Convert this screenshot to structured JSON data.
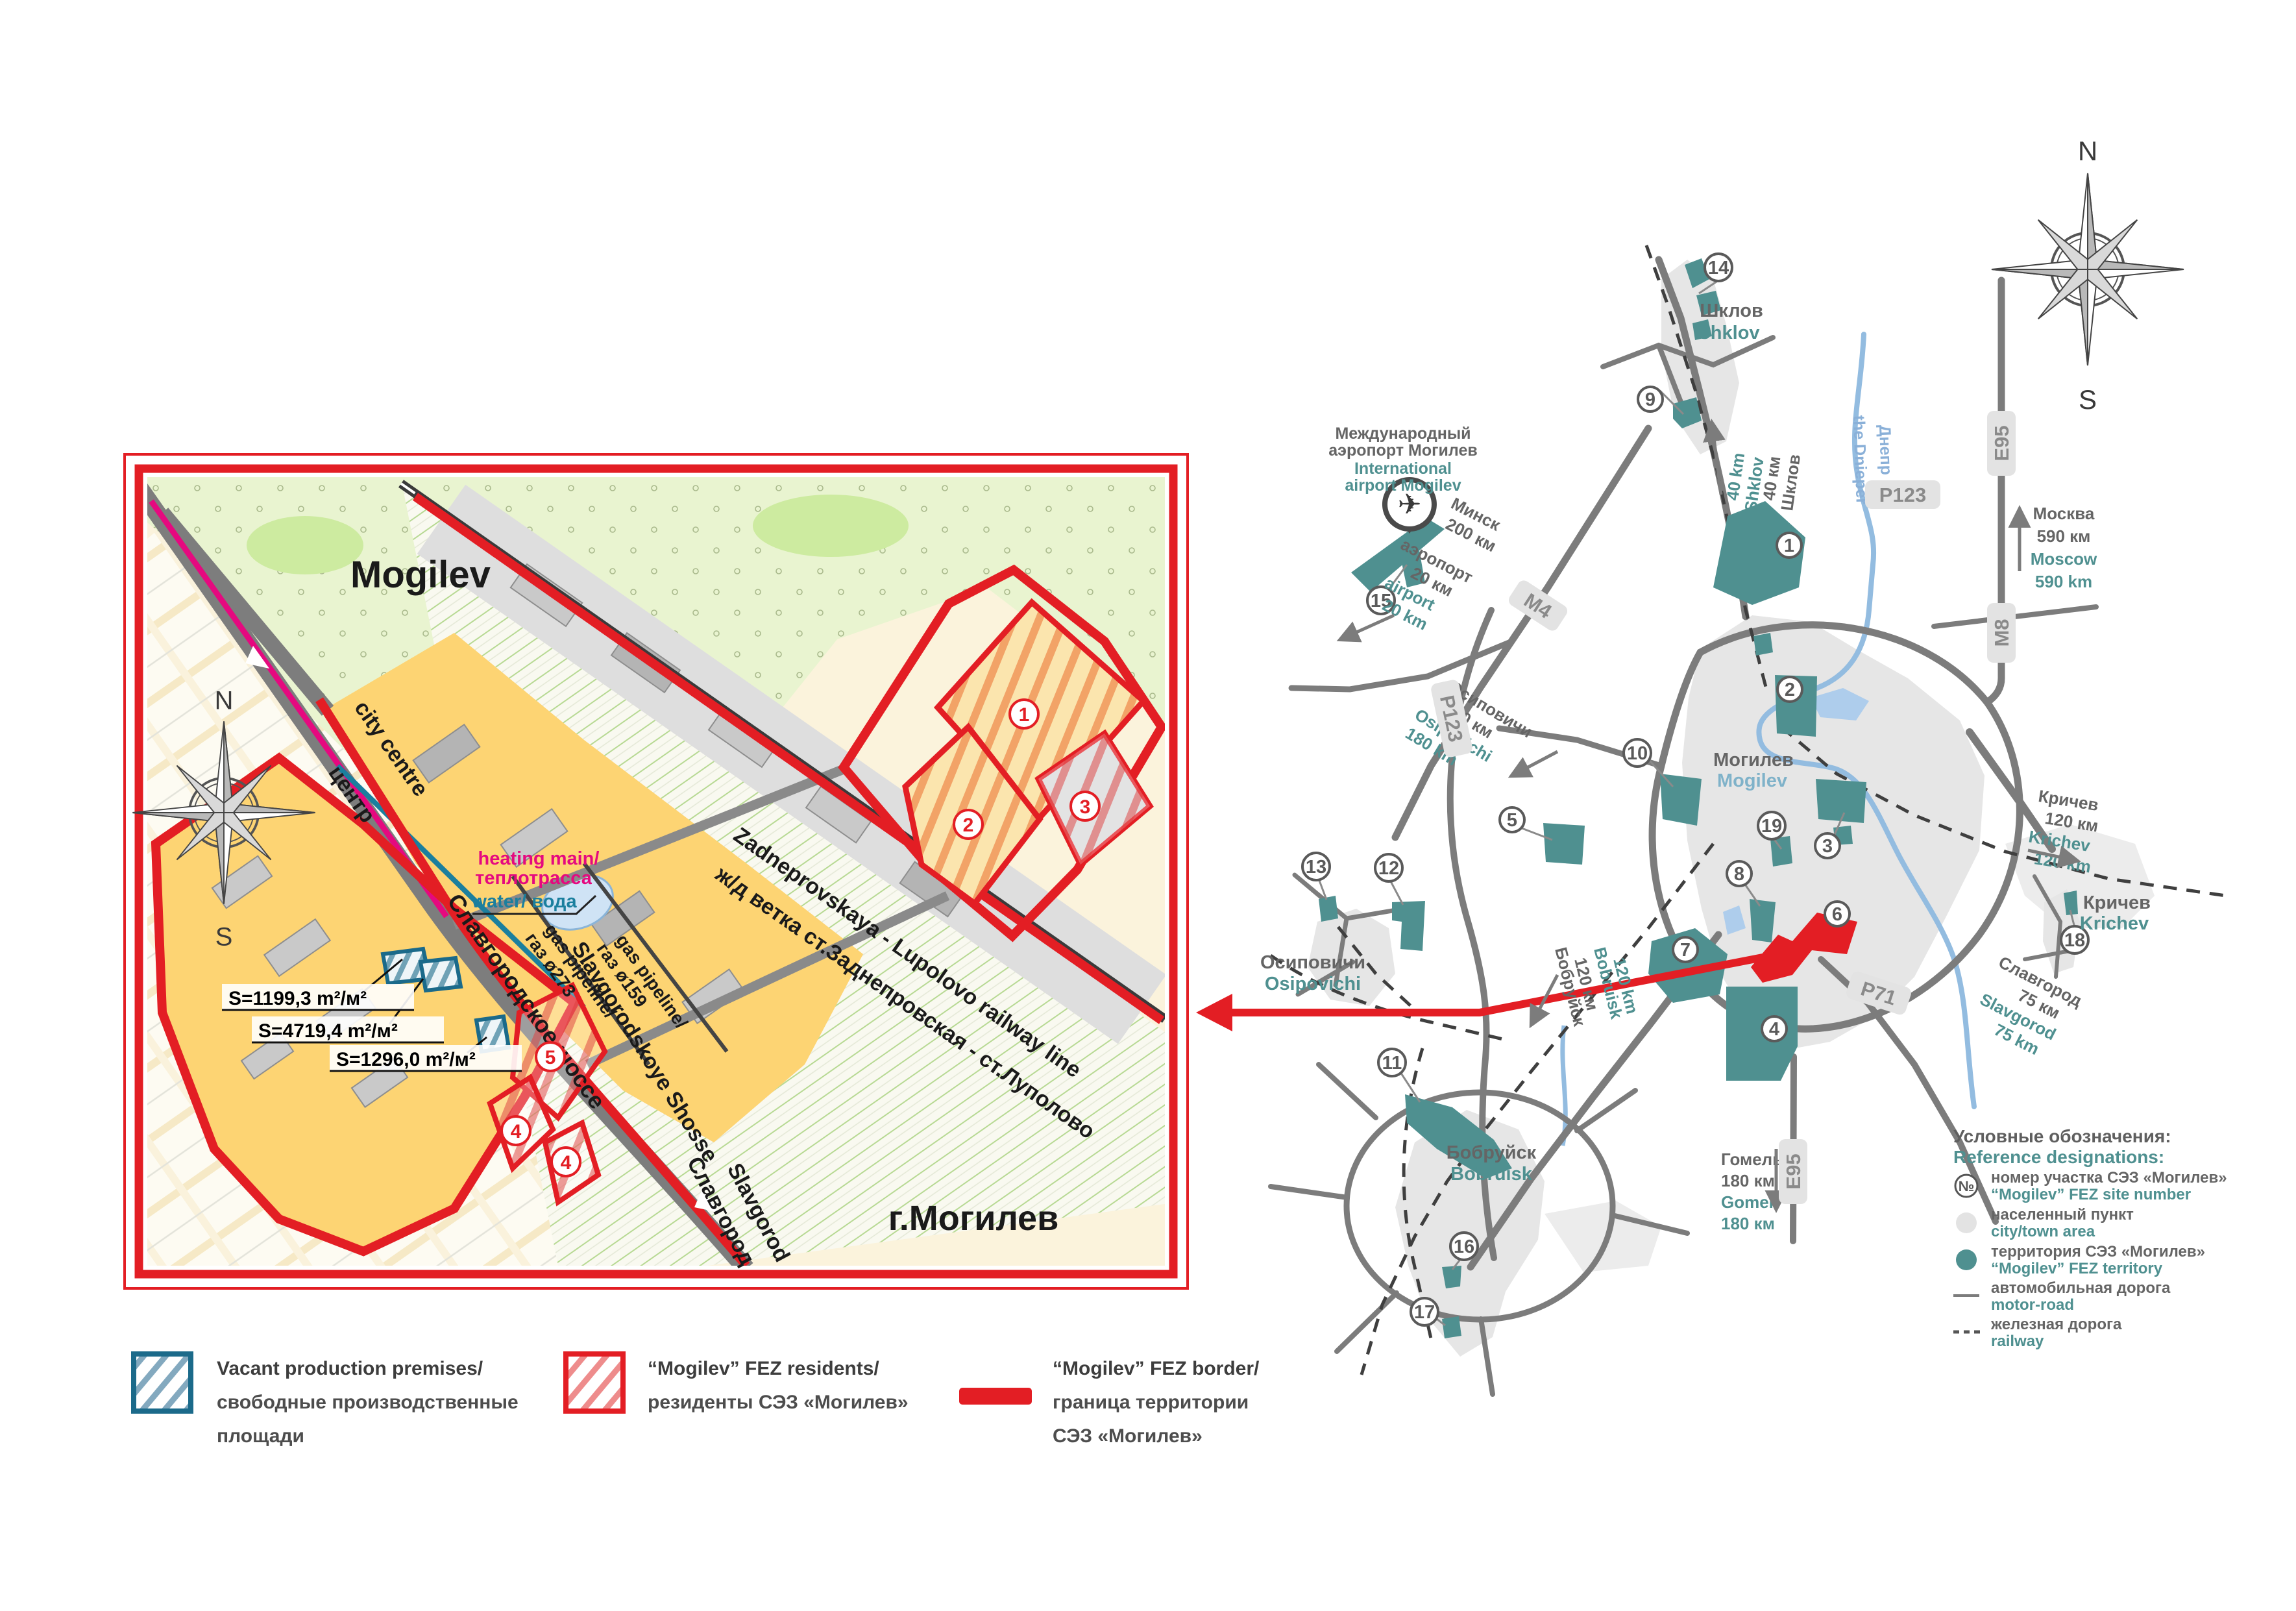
{
  "compass": {
    "n": "N",
    "s": "S"
  },
  "inset": {
    "title": "Mogilev",
    "city_label": "г.Могилев",
    "roads": {
      "city_centre_en": "city centre",
      "city_centre_ru": "центр",
      "shosse_ru": "Славгородское шоссе",
      "shosse_en": "Slavgorodskoye Shosse",
      "slavgorod_ru": "Славгород",
      "slavgorod_en": "Slavgorod"
    },
    "railway": {
      "en": "Zadneprovskaya - Lupolovo railway line",
      "ru": "ж/д ветка ст.Заднепровская - ст.Луполово"
    },
    "utilities": {
      "heating_en": "heating main/",
      "heating_ru": "теплотрасса",
      "water": "water/ вода",
      "gas1_en": "gas pipeline/",
      "gas1_ru": "газ ø273",
      "gas2_en": "gas pipeline/",
      "gas2_ru": "газ ø159"
    },
    "areas": [
      "S=1199,3 m²/м²",
      "S=4719,4 m²/м²",
      "S=1296,0 m²/м²"
    ],
    "sites": [
      "1",
      "2",
      "3",
      "5",
      "4",
      "4"
    ]
  },
  "regional": {
    "towns": {
      "shklov_ru": "Шклов",
      "shklov_en": "Shklov",
      "mogilev_ru": "Могилев",
      "mogilev_en": "Mogilev",
      "osipovichi_ru": "Осиповичи",
      "osipovichi_en": "Osipovichi",
      "bobruisk_ru": "Бобруйск",
      "bobruisk_en": "Bobruisk",
      "krichev_ru": "Кричев",
      "krichev_en": "Krichev"
    },
    "airport": {
      "ru1": "Международный",
      "ru2": "аэропорт Могилев",
      "en1": "International",
      "en2": "airport Mogilev"
    },
    "river": {
      "ru": "Днепр",
      "en": "the Dnieper"
    },
    "distances": {
      "minsk_ru": "Минск",
      "minsk_km_ru": "200 км",
      "airport_ru": "аэропорт",
      "airport_km_ru": "20 км",
      "airport_en": "airport",
      "airport_km_en": "20 km",
      "moscow_ru": "Москва",
      "moscow_km_ru": "590 км",
      "moscow_en": "Moscow",
      "moscow_km_en": "590 km",
      "shklov_ru": "Шклов",
      "shklov_km_ru": "40 км",
      "shklov_en": "Shklov",
      "shklov_km_en": "40 km",
      "osipovichi_ru": "Осиповичи",
      "osipovichi_km_ru": "180 км",
      "osipovichi_en": "Osipovichi",
      "osipovichi_km_en": "180 km",
      "bobruisk_ru": "Бобруйск",
      "bobruisk_km_ru": "120 км",
      "bobruisk_en": "Bobruisk",
      "bobruisk_km_en": "120 km",
      "krichev_ru": "Кричев",
      "krichev_km_ru": "120 км",
      "krichev_en": "Krichev",
      "krichev_km_en": "120 km",
      "slavgorod_ru": "Славгород",
      "slavgorod_km_ru": "75 км",
      "slavgorod_en": "Slavgorod",
      "slavgorod_km_en": "75 km",
      "gomel_ru": "Гомель",
      "gomel_km_ru": "180 км",
      "gomel_en": "Gomel",
      "gomel_km_en": "180 км"
    },
    "road_badges": {
      "m4": "М4",
      "p123a": "Р123",
      "p123b": "Р123",
      "e95a": "Е95",
      "m8": "М8",
      "p71": "Р71",
      "e95b": "Е95"
    },
    "sites": [
      "1",
      "2",
      "3",
      "4",
      "5",
      "6",
      "7",
      "8",
      "9",
      "10",
      "11",
      "12",
      "13",
      "14",
      "15",
      "16",
      "17",
      "18",
      "19"
    ],
    "legend": {
      "title_ru": "Условные обозначения:",
      "title_en": "Reference designations:",
      "site_symbol": "№",
      "items": [
        {
          "ru": "номер участка СЭЗ «Могилев»",
          "en": "“Mogilev” FEZ site number"
        },
        {
          "ru": "населенный пункт",
          "en": "city/town area"
        },
        {
          "ru": "территория СЭЗ «Могилев»",
          "en": "“Mogilev” FEZ territory"
        },
        {
          "ru": "автомобильная дорога",
          "en": "motor-road"
        },
        {
          "ru": "железная дорога",
          "en": "railway"
        }
      ]
    }
  },
  "legend": {
    "vacant": {
      "en": "Vacant production premises/",
      "ru1": "свободные производственные",
      "ru2": "площади"
    },
    "residents": {
      "en": "“Mogilev” FEZ residents/",
      "ru": "резиденты СЭЗ «Могилев»"
    },
    "border": {
      "en": "“Mogilev” FEZ border/",
      "ru1": "граница территории",
      "ru2": "СЭЗ «Могилев»"
    }
  },
  "colors": {
    "accent_red": "#e31e24",
    "teal": "#4f9090",
    "magenta": "#e5097f",
    "water_blue": "#8fb8e0"
  }
}
